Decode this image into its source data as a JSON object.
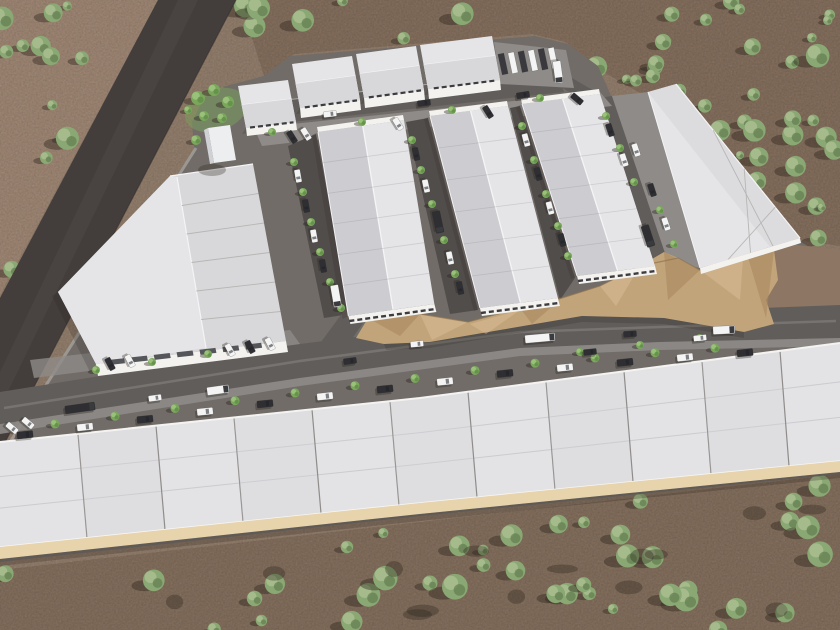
{
  "scene": {
    "title": "Industrial park aerial rendering",
    "description": "Aerial 3D architectural rendering of an industrial warehouse park under construction in desert scrubland. A dark asphalt road runs diagonally along the north-west boundary. The site contains one large distribution warehouse with a paneled roof, three long gable-roof warehouse rows with parking aisles, a row of small flex buildings with a semi-trailer yard at the north, a wedge-shaped warehouse along the north-east edge, a graded dirt cut slope in the east-center, and a long band of warehouse units with a beige front wall across the south. Cars, vans and trucks occupy internal roads; green trees line the streets; scattered desert bushes cover the surrounding terrain.",
    "style": "photorealistic 3D render, top-down oblique aerial view, afternoon light with shadows cast to the south-west",
    "terrain": {
      "type": "desert scrubland",
      "vegetation": "scattered round bushes and small trees with dark shadows",
      "excavation": "unfinished graded dirt pad with faceted cut slopes, east-center of site"
    },
    "site_elements": {
      "access_road": "dark asphalt road, north-west diagonal",
      "large_warehouse": "large paneled-roof distribution warehouse, west block",
      "warehouse_rows": 3,
      "small_flex_buildings": 4,
      "truck_yard_trailers": 6,
      "east_wedge_building": 1,
      "south_unit_band_panels": 11,
      "entry_tower": 1
    },
    "counts": {
      "desert_trees_approx": 99,
      "site_trees_approx": 46,
      "vehicles_approx": 48
    },
    "colors": {
      "bg": "#9c8673",
      "desertTL": "#a98f7b",
      "desertTop": "#8d7663",
      "desertBottom": "#8c7663",
      "darkRoad": "#433e3c",
      "darkRoadStreak": "#4e4946",
      "plateau": "#716c68",
      "sidewalk": "#a5a29e",
      "roadMain": "#615d5a",
      "roadAisle": "#514d4b",
      "apron": "#8e8b88",
      "curb": "#c6c3c0",
      "roofLight": "#e5e5e8",
      "roofMid": "#d8d8db",
      "roofDark": "#cdcdd1",
      "roofRidge": "#f5f5f7",
      "wallWhite": "#f3f2ef",
      "canopyDark": "#55565a",
      "windowDark": "#3c3c40",
      "bandRoof": "#e3e3e6",
      "bandLine": "#8f8c89",
      "tanWall": "#e7d3ac",
      "cliffBase": "#c2a47a",
      "cliffLight": "#d5bb92",
      "cliffDark": "#a8895f",
      "cliffEdge": "#8d7350",
      "treeDesLight": "#a9bd8e",
      "treeDesMid": "#8aa873",
      "treeDesDark": "#647e50",
      "treeDevLight": "#9cc47c",
      "treeDevMid": "#7aa75c",
      "treeDevDark": "#5d8a44",
      "shadow": "#2a241c",
      "vehicleWhite": "#f4f4f4",
      "vehicleDark": "#2f2f33",
      "vehicleGray": "#a8a8aa"
    }
  }
}
